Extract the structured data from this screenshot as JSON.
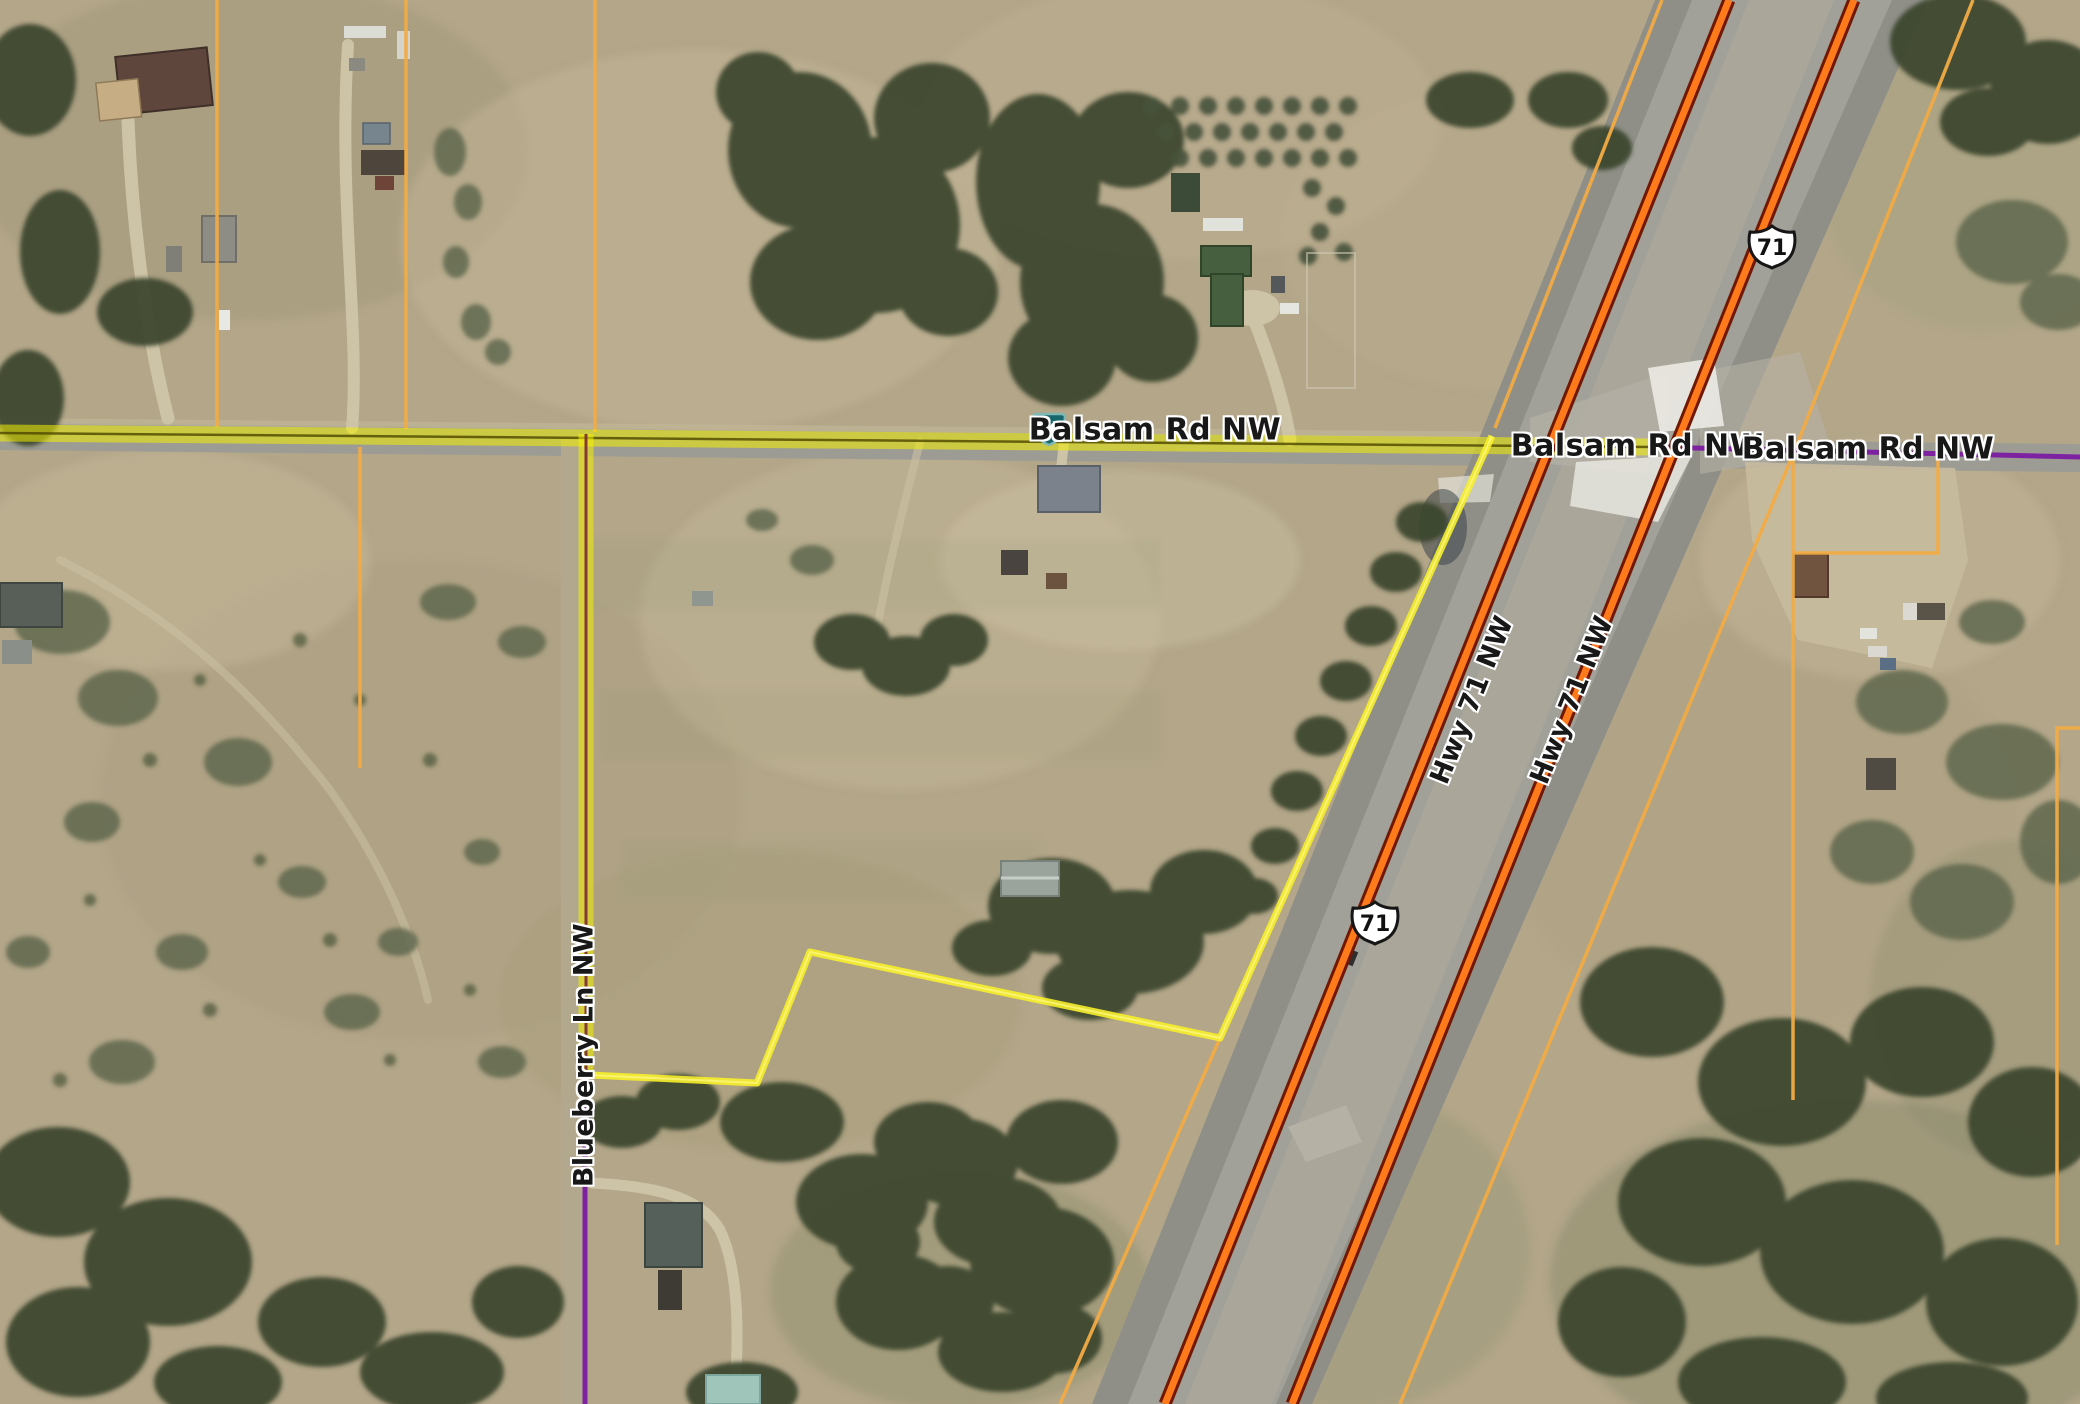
{
  "map": {
    "road_labels": {
      "balsam_west": "Balsam Rd NW",
      "balsam_center": "Balsam Rd NW",
      "balsam_east": "Balsam Rd NW",
      "hwy71_west_carriageway": "Hwy 71 NW",
      "hwy71_east_carriageway": "Hwy 71 NW",
      "blueberry": "Blueberry Ln NW"
    },
    "shields": {
      "county_40": "40",
      "us_71_north": "71",
      "us_71_south": "71"
    },
    "legend_colors": {
      "highlighted_parcel_boundary": "#f7ef2a",
      "highlighted_road": "#f4f000",
      "parcel_line": "#f2ab45",
      "us_highway_line": "#ff7a1a",
      "us_highway_casing": "#701802",
      "local_road_line": "#7d22a0",
      "county_shield_fill": "#17666b"
    }
  }
}
